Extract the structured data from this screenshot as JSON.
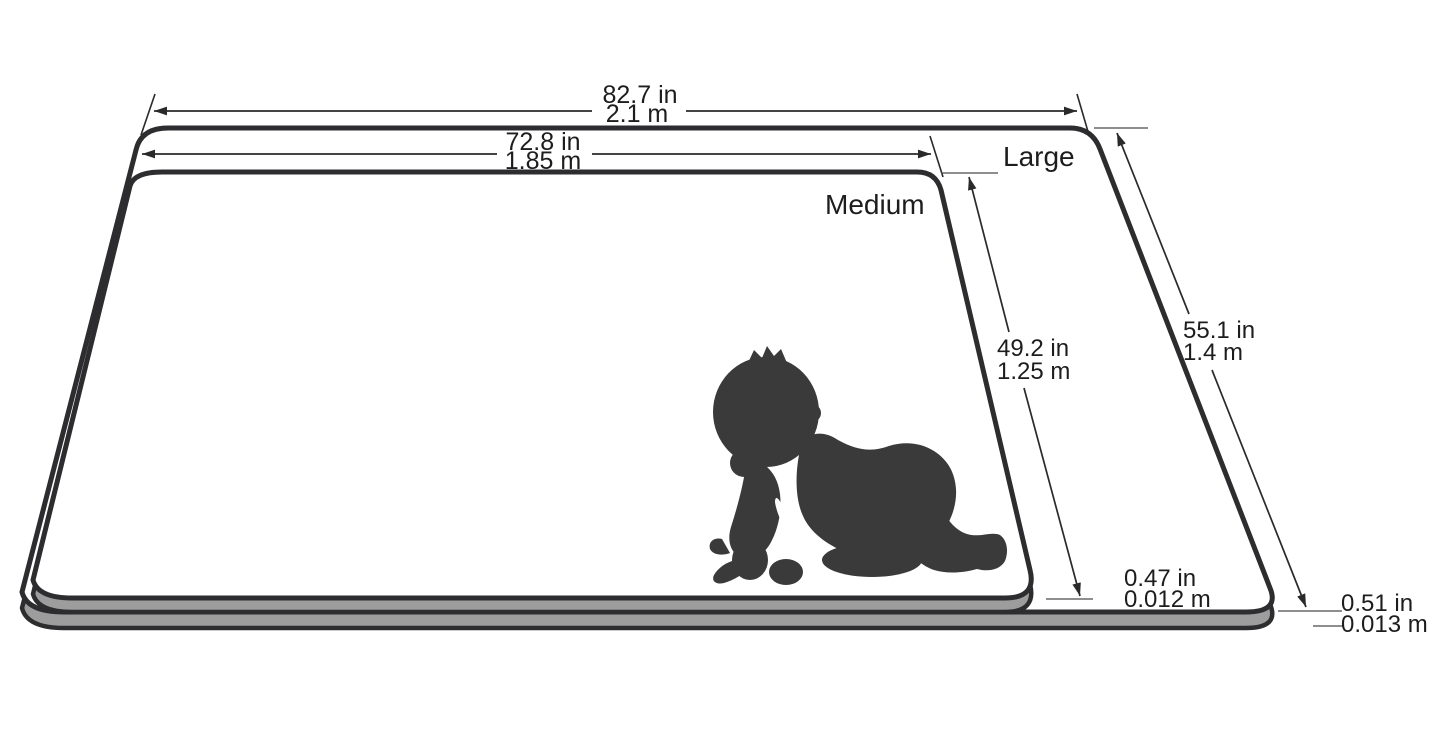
{
  "mats": {
    "large": {
      "label": "Large",
      "width_imperial": "82.7 in",
      "width_metric": "2.1 m",
      "depth_imperial": "55.1 in",
      "depth_metric": "1.4 m",
      "thickness_imperial": "0.51 in",
      "thickness_metric": "0.013 m"
    },
    "medium": {
      "label": "Medium",
      "width_imperial": "72.8 in",
      "width_metric": "1.85 m",
      "depth_imperial": "49.2 in",
      "depth_metric": "1.25 m",
      "thickness_imperial": "0.47 in",
      "thickness_metric": "0.012 m"
    }
  },
  "icons": {
    "baby": "crawling-baby-silhouette"
  },
  "colors": {
    "background": "#ffffff",
    "outline": "#2d2d30",
    "mat_surface": "#ffffff",
    "mat_edge_fill": "#9d9d9d",
    "silhouette": "#3a3a3a",
    "text": "#1d1d1d",
    "dimension_line": "#2a2a2a"
  }
}
